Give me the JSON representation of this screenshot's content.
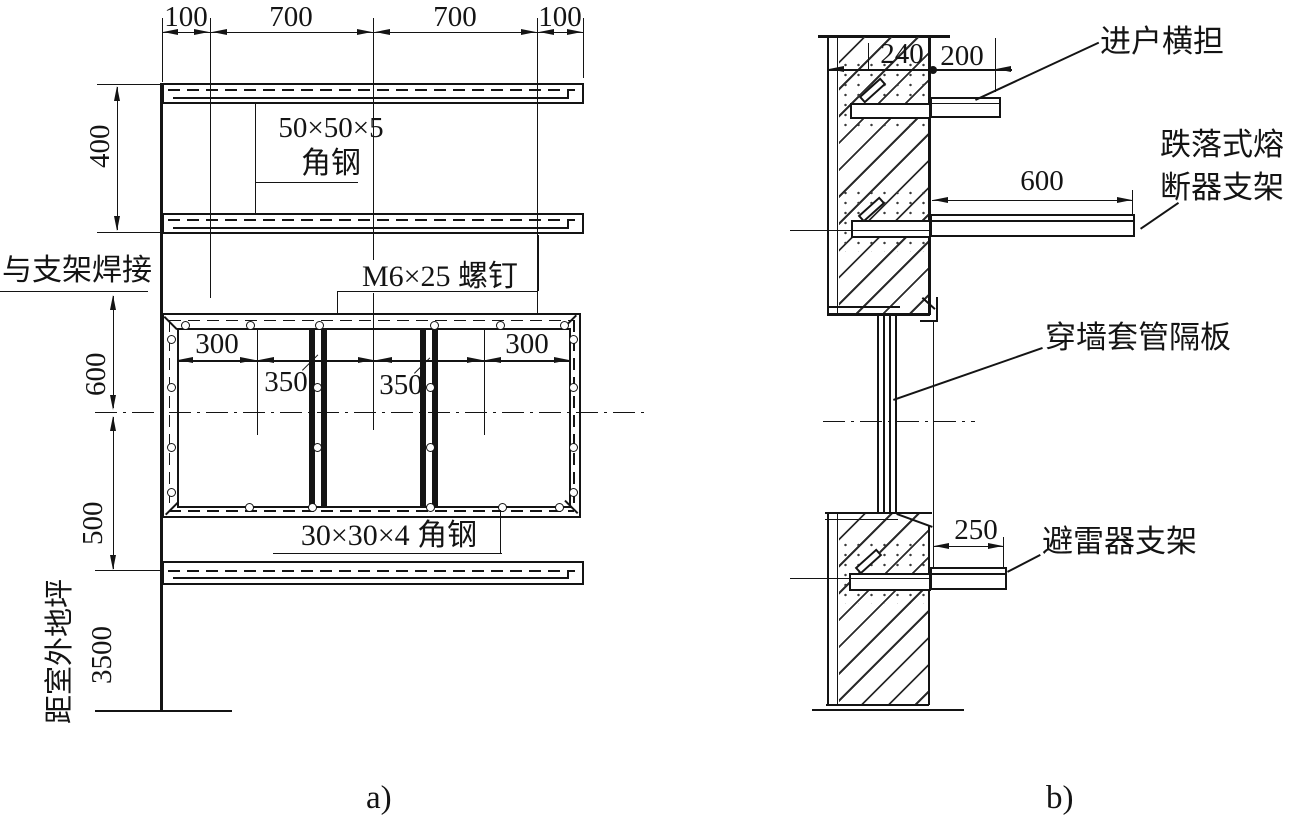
{
  "colors": {
    "ink": "#141414",
    "paper": "#ffffff"
  },
  "a": {
    "caption": "a)",
    "top_dims": [
      "100",
      "700",
      "700",
      "100"
    ],
    "dim_gap_crossarms": "400",
    "dim_upper": "600",
    "dim_lower": "500",
    "dim_to_ground": "3500",
    "inner_dims": [
      "300",
      "350",
      "350",
      "300"
    ],
    "labels": {
      "angle_size": "50×50×5",
      "angle": "角钢",
      "weld": "与支架焊接",
      "screws": "M6×25 螺钉",
      "bottom_angle": "30×30×4 角钢",
      "ground_level": "距室外地坪"
    }
  },
  "b": {
    "caption": "b)",
    "dims": {
      "wall": "240",
      "offset": "200",
      "fuse": "600",
      "arrester": "250"
    },
    "labels": {
      "entry_crossarm": "进户横担",
      "fuse_line1": "跌落式熔",
      "fuse_line2": "断器支架",
      "wall_bushing": "穿墙套管隔板",
      "arrester": "避雷器支架"
    }
  }
}
